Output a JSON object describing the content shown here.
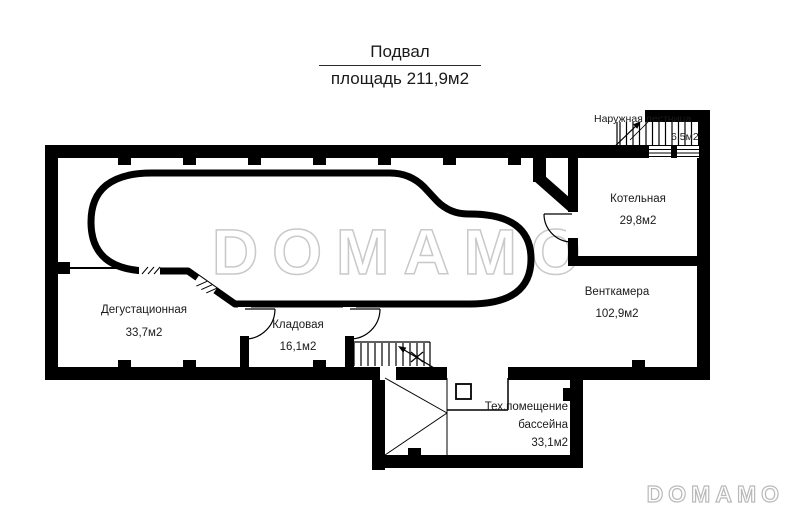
{
  "title": {
    "line1": "Подвал",
    "line2": "площадь 211,9м2"
  },
  "rooms": [
    {
      "id": "naruzhnaya-lestnitsa",
      "name": "Наружная лестница",
      "area": "6,5м2"
    },
    {
      "id": "kotelnaya",
      "name": "Котельная",
      "area": "29,8м2"
    },
    {
      "id": "ventkamera",
      "name": "Венткамера",
      "area": "102,9м2"
    },
    {
      "id": "degustatsionnaya",
      "name": "Дегустационная",
      "area": "33,7м2"
    },
    {
      "id": "kladovaya",
      "name": "Кладовая",
      "area": "16,1м2"
    },
    {
      "id": "tekh-pomeshchenie-basseyna",
      "name": "Тех.помещение бассейна",
      "area": "33,1м2"
    }
  ],
  "watermark": {
    "center": "DOMAMO",
    "corner": "DOMAMO"
  },
  "colors": {
    "background": "#ffffff",
    "walls": "#000000",
    "text": "#1a1a1a",
    "watermark": "#c9c9c9"
  }
}
